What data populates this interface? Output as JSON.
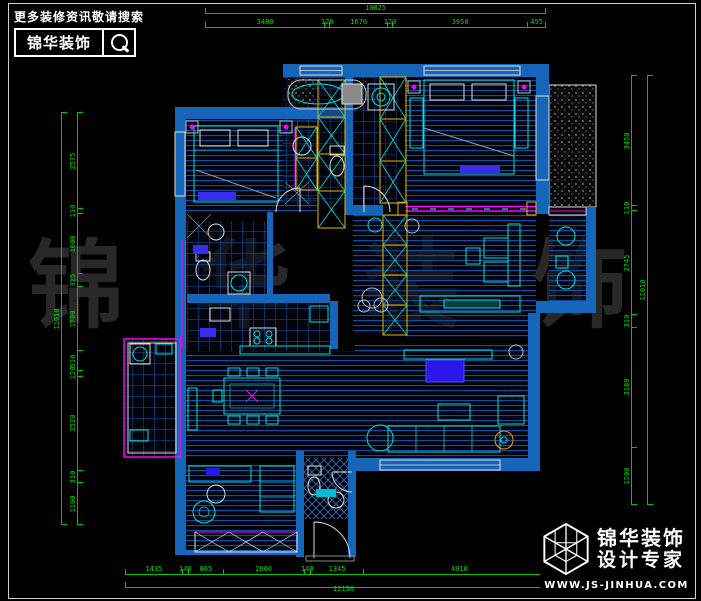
{
  "branding_top": {
    "slogan": "更多装修资讯敬请搜索",
    "brand": "锦华装饰",
    "icon": "magnifier-icon"
  },
  "branding_bottom": {
    "brand": "锦华装饰",
    "tagline": "设计专家",
    "url": "WWW.JS-JINHUA.COM",
    "icon": "cube-logo-icon"
  },
  "watermark": {
    "text": "锦华装饰"
  },
  "dimensions": {
    "top": {
      "total": "10025",
      "segments": [
        "3480",
        "120",
        "1670",
        "120",
        "3950",
        "495"
      ]
    },
    "bottom": {
      "total": "12150",
      "segments": [
        "1435",
        "140",
        "865",
        "2060",
        "140",
        "1345",
        "4910",
        "140"
      ]
    },
    "left": {
      "total": "11010",
      "segments": [
        "2575",
        "110",
        "1600",
        "325",
        "1700",
        "510",
        "120",
        "2520",
        "310",
        "1100"
      ]
    },
    "right": {
      "total": "11010",
      "segments": [
        "3450",
        "110",
        "2745",
        "310",
        "3180",
        "1500"
      ]
    }
  },
  "colors": {
    "background": "#000000",
    "dimension_green": "#00dc00",
    "wall_blue": "#1565b8",
    "floor_line_blue": "#0e4fa6",
    "furniture_cyan": "#00e0e0",
    "accent_magenta": "#ff00ff",
    "closet_yellow": "#f0b400",
    "appliance_orange": "#ff9800",
    "bed_runner_purple": "#3a2ced",
    "watermark_gray": "#282828",
    "frame_white": "#cfcfcf"
  }
}
